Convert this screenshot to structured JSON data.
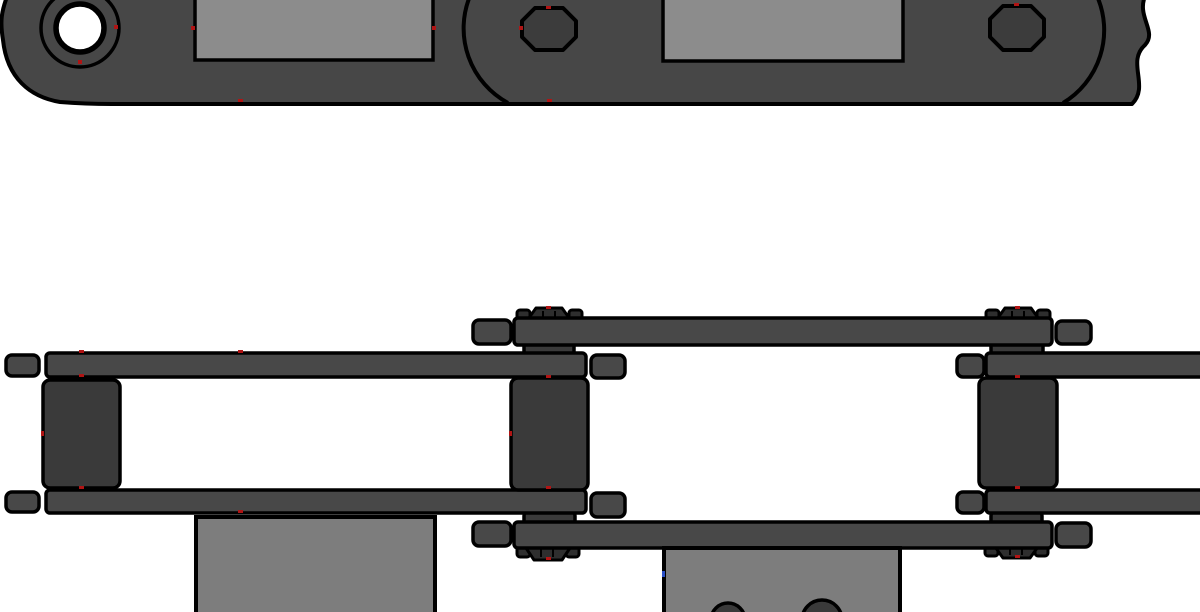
{
  "drawing": {
    "type": "cad-orthographic-views",
    "subject": "conveyor roller chain with bent attachment plates",
    "views": [
      {
        "id": "side-view",
        "role": "side elevation of chain strand"
      },
      {
        "id": "plan-view",
        "role": "plan view of chain strand with attachments"
      }
    ],
    "parts": [
      "link-plate-body",
      "pin-hole",
      "pin-head",
      "plate-end-arc",
      "break-line",
      "attachment-tab",
      "inner-link-plate",
      "outer-link-plate",
      "plate-end-cap",
      "roller",
      "bushing-collar",
      "castellated-pin-end",
      "bent-attachment-plate",
      "attachment-bolt-hole",
      "vertex-marker"
    ]
  },
  "colors": {
    "background": "#ffffff",
    "chain_body": "#474747",
    "plate": "#484848",
    "roller": "#3a3a3a",
    "pin_head": "#2e2e2e",
    "pin_octagon": "#3c3c3c",
    "attachment": "#7d7d7d",
    "attachment_side": "#8c8c8c",
    "hole_white": "#ffffff",
    "outline": "#000000",
    "marker_red": "#b01414",
    "marker_blue": "#2b50c8"
  }
}
